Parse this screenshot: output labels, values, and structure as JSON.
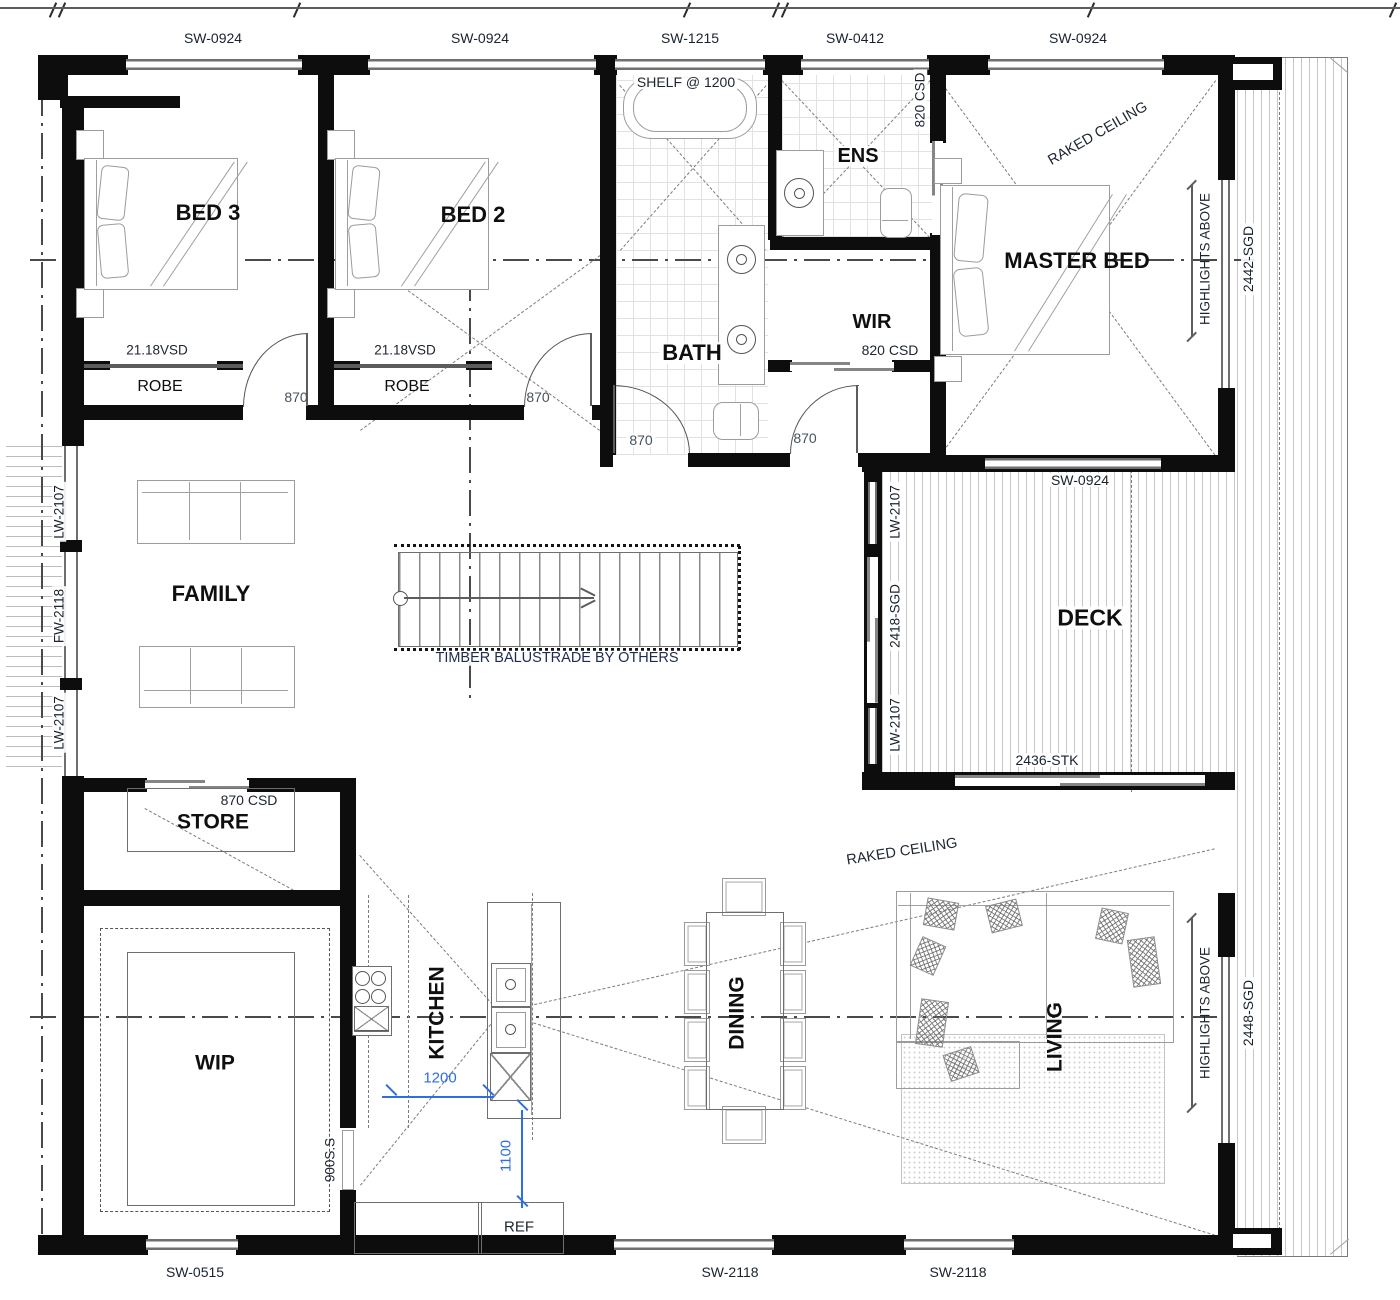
{
  "plan": {
    "rooms": {
      "bed3": "BED 3",
      "bed2": "BED 2",
      "bath": "BATH",
      "ens": "ENS",
      "wir": "WIR",
      "master": "MASTER BED",
      "family": "FAMILY",
      "deck": "DECK",
      "store": "STORE",
      "wip": "WIP",
      "kitchen": "KITCHEN",
      "dining": "DINING",
      "living": "LIVING"
    },
    "windows": {
      "top": [
        {
          "label": "SW-0924"
        },
        {
          "label": "SW-0924"
        },
        {
          "label": "SW-1215"
        },
        {
          "label": "SW-0412"
        },
        {
          "label": "SW-0924"
        }
      ],
      "left": [
        {
          "label": "LW-2107"
        },
        {
          "label": "FW-2118"
        },
        {
          "label": "LW-2107"
        }
      ],
      "deck_left": [
        {
          "label": "LW-2107"
        },
        {
          "label": "2418-SGD"
        },
        {
          "label": "LW-2107"
        }
      ],
      "deck_top": "SW-0924",
      "deck_bottom": "2436-STK",
      "right_master": "2442-SGD",
      "right_living": "2448-SGD",
      "bottom": [
        {
          "label": "SW-0515"
        },
        {
          "label": "SW-2118"
        },
        {
          "label": "SW-2118"
        }
      ]
    },
    "doors": {
      "robe_vsd_1": "21.18VSD",
      "robe_vsd_2": "21.18VSD",
      "door870_bed3": "870",
      "door870_bed2": "870",
      "door870_bath": "870",
      "door870_master": "870",
      "csd820_ens": "820 CSD",
      "csd820_wir": "820 CSD",
      "csd870_store": "870 CSD"
    },
    "annotations": {
      "shelf": "SHELF @ 1200",
      "raked_ceiling_master": "RAKED CEILING",
      "raked_ceiling_living": "RAKED CEILING",
      "highlights_master": "HIGHLIGHTS ABOVE",
      "highlights_living": "HIGHLIGHTS ABOVE",
      "balustrade": "TIMBER BALUSTRADE BY OTHERS",
      "robe1": "ROBE",
      "robe2": "ROBE",
      "ss900": "900S.S",
      "ref": "REF"
    },
    "dimensions": {
      "island_clearance": "1200",
      "walkway": "1100"
    }
  }
}
